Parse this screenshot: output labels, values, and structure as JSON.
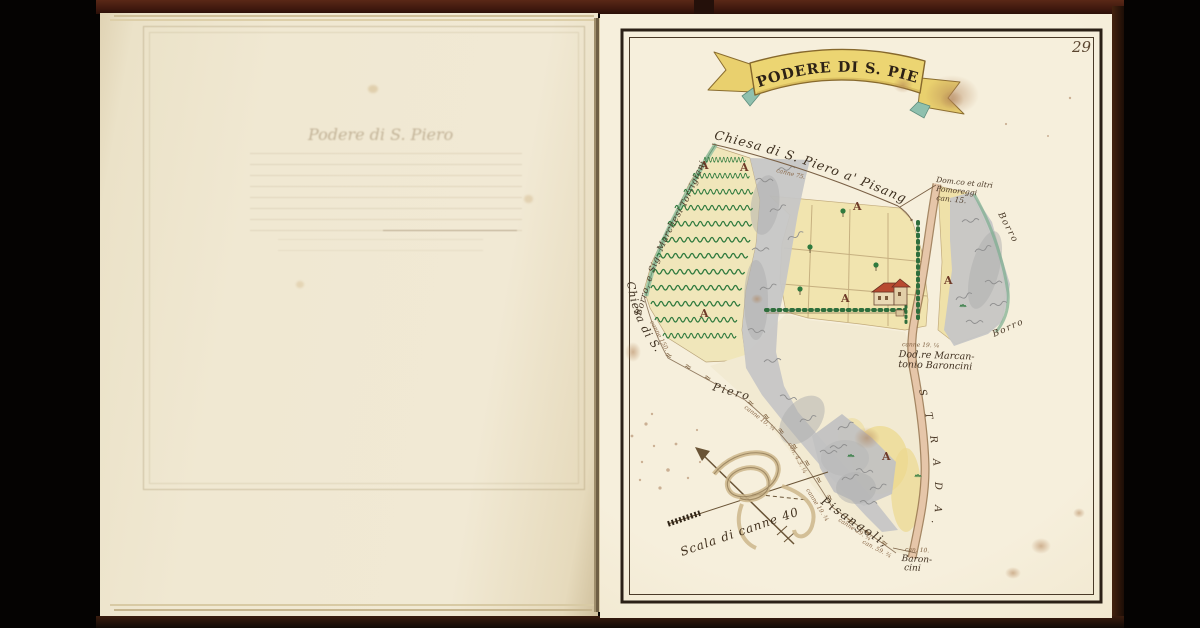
{
  "page_number": "29",
  "banner": {
    "title": "PODERE DI S. PIERO"
  },
  "left_page": {
    "ghost_title": "Podere di S. Piero"
  },
  "map": {
    "labels": {
      "top_boundary": "Chiesa di S. Piero a' Pisangoli",
      "stream_left": "Borro, e Sig. Marchesi Torrigiani",
      "boundary_chiesa": "Chiesa di S.",
      "boundary_piero": "Piero",
      "boundary_pisangoli": "Pisangoli,",
      "borro_upper": "Borro",
      "borro_lower": "Borro",
      "field_letter": "A",
      "marks_short": "≈ ≈ ≈",
      "marks_long": "≈ ≈ ≈ ≈ ≈ ≈ ≈ ≈",
      "road_letters": [
        "S",
        "T",
        "R",
        "A",
        "D",
        "A",
        "."
      ],
      "neighbor_ne": [
        "Dom.co et altri",
        "Pomoreggi",
        "can. 15."
      ],
      "owner_e": [
        "canne 19. ¼",
        "Dod.re Marcan-",
        "tonio Baroncini"
      ],
      "neighbor_se": [
        "can. 10.",
        "Baron-",
        "cini"
      ],
      "measures": [
        "canne 75.",
        "canne 150.",
        "canne 10. ¼",
        "can. 4.3. ¼",
        "canne 19. ¾",
        "canne 29. ¾",
        "can. 59. ¾"
      ]
    },
    "compass": {
      "scale_label": "Scala di canne 40"
    },
    "colors": {
      "paper": "#f3ebd7",
      "banner_yellow": "#ebd475",
      "vine_green": "#2f7a3e",
      "rock_gray": "#c4c4c4",
      "road_tan": "#e6c6a9",
      "ink": "#3a2d1d"
    }
  }
}
